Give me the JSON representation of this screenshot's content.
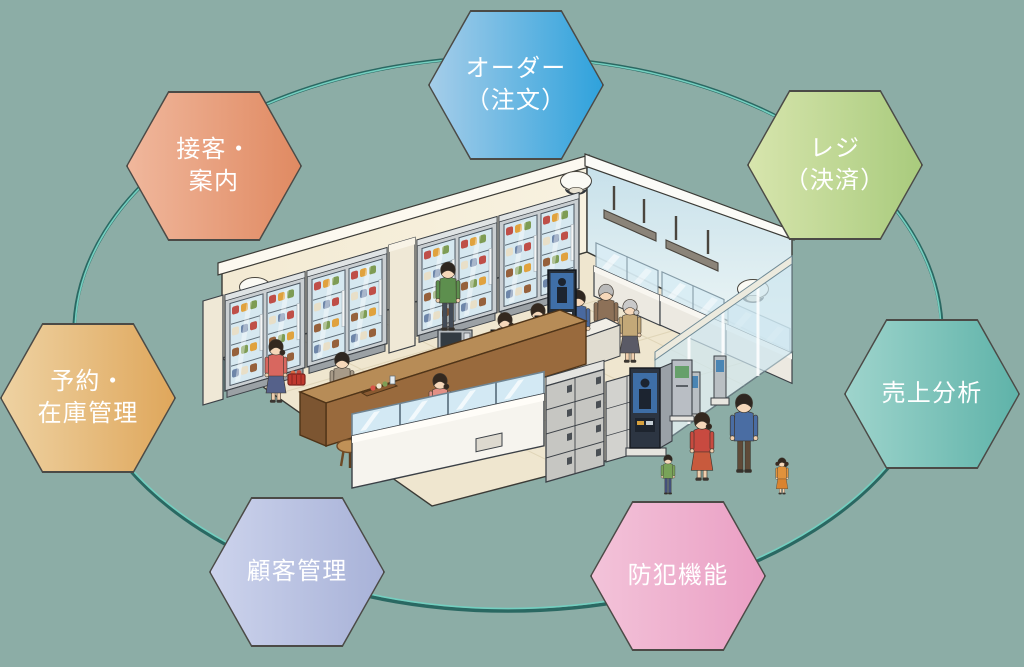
{
  "canvas": {
    "width": 1024,
    "height": 667,
    "background_color": "#8cada6"
  },
  "connection_ring": {
    "dark_color": "#2a6862",
    "light_color": "#74cfc0"
  },
  "hexagons": [
    {
      "id": "order",
      "lines": [
        "オーダー",
        "（注文）"
      ],
      "gradient_start": "#a5cde9",
      "gradient_end": "#2fa2dc"
    },
    {
      "id": "register-payment",
      "lines": [
        "レジ",
        "（決済）"
      ],
      "gradient_start": "#d7e5ad",
      "gradient_end": "#a9cb7d"
    },
    {
      "id": "sales-analysis",
      "lines": [
        "売上分析"
      ],
      "gradient_start": "#9ed4cc",
      "gradient_end": "#5fb3a9"
    },
    {
      "id": "security",
      "lines": [
        "防犯機能"
      ],
      "gradient_start": "#f3c3d9",
      "gradient_end": "#ea9fc4"
    },
    {
      "id": "customer-management",
      "lines": [
        "顧客管理"
      ],
      "gradient_start": "#ccd3ec",
      "gradient_end": "#a8b2d8"
    },
    {
      "id": "reservation-inventory",
      "lines": [
        "予約・",
        "在庫管理"
      ],
      "gradient_start": "#eed2a2",
      "gradient_end": "#dfa75c"
    },
    {
      "id": "customer-service",
      "lines": [
        "接客・",
        "案内"
      ],
      "gradient_start": "#f0b79c",
      "gradient_end": "#e08a62"
    }
  ],
  "illustration": {
    "scene": "スマートストア店内のアイソメトリックイラスト（冷蔵ショーケース・カウンター・ロッカー・キオスク・買い物客・家族）",
    "text_labels": []
  }
}
